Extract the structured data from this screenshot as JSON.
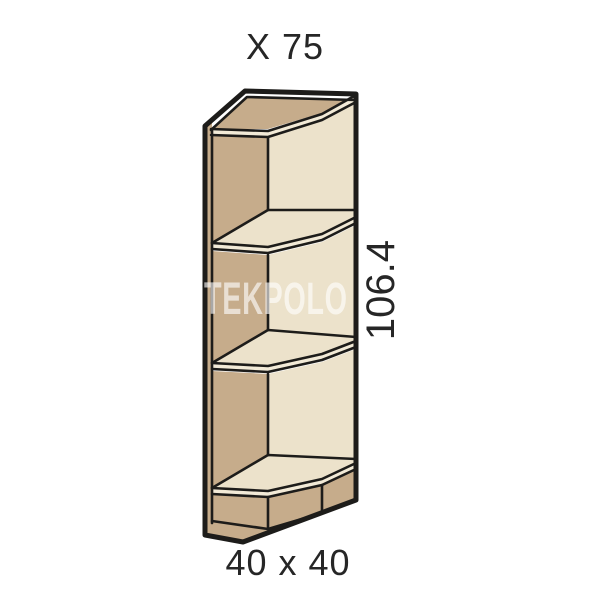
{
  "title": {
    "text": "X 75"
  },
  "dimensions": {
    "height_label": "106.4",
    "footprint_label": "40 x 40"
  },
  "watermark": {
    "text": "TEKPOLO",
    "color": "rgba(255,255,255,0.62)"
  },
  "drawing": {
    "description": "open corner shelf end unit, 3 compartments, beveled front corner",
    "compartments": 3,
    "colors": {
      "outline": "#1d1c1a",
      "panel_dark": "#c6ac8b",
      "panel_light": "#ece2cb",
      "edge_band": "#f2ead7",
      "background": "#ffffff"
    }
  }
}
